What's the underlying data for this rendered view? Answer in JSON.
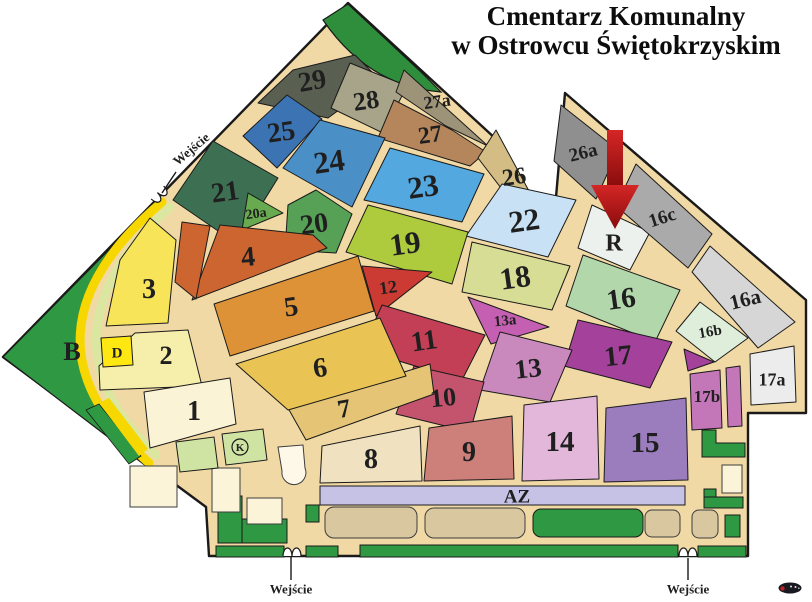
{
  "title": {
    "line1": "Cmentarz Komunalny",
    "line2": "w Ostrowcu Świętokrzyskim"
  },
  "map": {
    "width": 812,
    "height": 602,
    "colors": {
      "path": "#f1d9a5",
      "outline": "#1a1a1a",
      "label": "#1f1f1f"
    },
    "outline_points": "348,3 497,140 553,232 565,93 806,300 806,413 748,413 748,556 209,556 206,507 3,357",
    "park_shapes": [
      {
        "name": "grove-top-corner",
        "type": "path",
        "d": "M 323,20 L 348,4 L 420,71 L 441,92 Q 368,86 323,20 Z",
        "fill": "#2e8e3c",
        "stroke": "#1a1a1a",
        "sw": 1.2
      },
      {
        "name": "park-b-area",
        "type": "path",
        "d": "M 160,198 L 3,357 L 146,466 Q 0,335 160,198 Z",
        "fill": "#2f9842",
        "stroke": "#1a1a1a",
        "sw": 1.2
      },
      {
        "name": "band-yellow",
        "type": "path",
        "d": "M 162,202 Q 5,336 149,463",
        "fill": "none",
        "stroke": "#f6d800",
        "sw": 9
      },
      {
        "name": "band-pale-green",
        "type": "path",
        "d": "M 170,207 Q 30,336 156,455",
        "fill": "none",
        "stroke": "#dbe7a0",
        "sw": 9
      },
      {
        "name": "edge-strip-green",
        "type": "polygon",
        "points": "86,410 99,404 141,456 129,464",
        "fill": "#2f9842",
        "stroke": "#1a1a1a",
        "sw": 0.8
      },
      {
        "name": "edge-strip-yellow",
        "type": "polygon",
        "points": "99,403 109,398 148,449 139,456",
        "fill": "#f6d800",
        "stroke": "none",
        "sw": 0
      }
    ],
    "sections": [
      {
        "id": "29",
        "label": "29",
        "color": "#5a6051",
        "points": "293,70 355,55 380,80 328,118 258,103",
        "lx": 312,
        "ly": 80,
        "fs": 28,
        "rot": -10
      },
      {
        "id": "28",
        "label": "28",
        "color": "#a8a489",
        "points": "350,63 407,86 383,133 331,108",
        "lx": 366,
        "ly": 100,
        "fs": 26,
        "rot": -8
      },
      {
        "id": "27a",
        "label": "27a",
        "color": "#9d9378",
        "points": "404,70 488,146 446,126 396,92",
        "lx": 437,
        "ly": 101,
        "fs": 18,
        "rot": -8
      },
      {
        "id": "27",
        "label": "27",
        "color": "#b5855c",
        "points": "394,100 452,130 486,152 470,166 378,138",
        "lx": 430,
        "ly": 134,
        "fs": 24,
        "rot": -8
      },
      {
        "id": "26",
        "label": "26",
        "color": "#d3bd85",
        "points": "496,130 549,228 524,218 478,158",
        "lx": 514,
        "ly": 176,
        "fs": 24,
        "rot": -8
      },
      {
        "id": "26a",
        "label": "26a",
        "color": "#8f8f8f",
        "points": "561,105 618,150 596,199 554,161",
        "lx": 583,
        "ly": 152,
        "fs": 19,
        "rot": -14
      },
      {
        "id": "25",
        "label": "25",
        "color": "#3c73b3",
        "points": "287,95 322,119 277,168 243,136",
        "lx": 281,
        "ly": 131,
        "fs": 28,
        "rot": -8
      },
      {
        "id": "24",
        "label": "24",
        "color": "#4b8fc7",
        "points": "320,120 385,138 352,207 283,168",
        "lx": 329,
        "ly": 161,
        "fs": 31,
        "rot": -8
      },
      {
        "id": "23",
        "label": "23",
        "color": "#54a8e0",
        "points": "390,148 484,174 462,222 364,200",
        "lx": 423,
        "ly": 186,
        "fs": 31,
        "rot": -8
      },
      {
        "id": "22",
        "label": "22",
        "color": "#c9e1f5",
        "points": "502,184 576,200 548,257 466,236",
        "lx": 524,
        "ly": 220,
        "fs": 31,
        "rot": -8
      },
      {
        "id": "21",
        "label": "21",
        "color": "#3d6f53",
        "points": "213,141 278,178 237,244 173,200",
        "lx": 225,
        "ly": 191,
        "fs": 28,
        "rot": -8
      },
      {
        "id": "20a",
        "label": "20a",
        "color": "#68aa50",
        "points": "248,193 283,213 242,230",
        "lx": 256,
        "ly": 213,
        "fs": 14,
        "rot": -8
      },
      {
        "id": "20",
        "label": "20",
        "color": "#56a156",
        "points": "288,205 316,190 352,214 336,253 285,250",
        "lx": 314,
        "ly": 223,
        "fs": 28,
        "rot": -8
      },
      {
        "id": "19",
        "label": "19",
        "color": "#aeca3d",
        "points": "368,205 468,232 452,284 346,252",
        "lx": 405,
        "ly": 243,
        "fs": 31,
        "rot": -8
      },
      {
        "id": "18",
        "label": "18",
        "color": "#d7dd95",
        "points": "472,242 570,266 552,310 462,292",
        "lx": 515,
        "ly": 277,
        "fs": 31,
        "rot": -8
      },
      {
        "id": "R",
        "label": "R",
        "color": "#edf1ed",
        "points": "592,205 650,232 630,270 578,248",
        "lx": 614,
        "ly": 242,
        "fs": 24,
        "rot": 0
      },
      {
        "id": "16c",
        "label": "16c",
        "color": "#aaaaaa",
        "points": "636,164 712,234 688,268 616,206",
        "lx": 662,
        "ly": 217,
        "fs": 19,
        "rot": -18
      },
      {
        "id": "16",
        "label": "16",
        "color": "#b2d7ab",
        "points": "583,255 680,290 655,342 566,306",
        "lx": 621,
        "ly": 298,
        "fs": 29,
        "rot": -8
      },
      {
        "id": "16a",
        "label": "16a",
        "color": "#d6d6d6",
        "points": "710,246 795,322 758,348 692,272",
        "lx": 745,
        "ly": 299,
        "fs": 21,
        "rot": -14
      },
      {
        "id": "16b",
        "label": "16b",
        "color": "#dfeeda",
        "points": "700,302 748,338 715,362 676,331",
        "lx": 710,
        "ly": 331,
        "fs": 15,
        "rot": -10
      },
      {
        "id": "17",
        "label": "17",
        "color": "#a3419b",
        "points": "578,320 672,342 650,388 564,366",
        "lx": 618,
        "ly": 355,
        "fs": 28,
        "rot": -6
      },
      {
        "id": "17t",
        "label": "",
        "color": "#a3419b",
        "points": "684,349 714,362 688,371",
        "lx": 0,
        "ly": 0,
        "fs": 0,
        "rot": 0
      },
      {
        "id": "17a",
        "label": "17a",
        "color": "#ececec",
        "points": "750,354 794,346 796,402 751,405",
        "lx": 772,
        "ly": 379,
        "fs": 18,
        "rot": 0
      },
      {
        "id": "17b",
        "label": "17b",
        "color": "#c377b8",
        "points": "690,374 720,370 722,428 692,430",
        "lx": 707,
        "ly": 396,
        "fs": 17,
        "rot": 0
      },
      {
        "id": "17b2",
        "label": "",
        "color": "#c377b8",
        "points": "726,368 740,366 742,426 728,427",
        "lx": 0,
        "ly": 0,
        "fs": 0,
        "rot": 0
      },
      {
        "id": "13a",
        "label": "13a",
        "color": "#c45fb2",
        "points": "468,297 549,327 491,344",
        "lx": 505,
        "ly": 320,
        "fs": 15,
        "rot": -6
      },
      {
        "id": "13",
        "label": "13",
        "color": "#c989bd",
        "points": "500,332 572,350 550,402 480,390",
        "lx": 528,
        "ly": 368,
        "fs": 27,
        "rot": -6
      },
      {
        "id": "14",
        "label": "14",
        "color": "#e3b7da",
        "points": "524,405 597,396 599,479 522,481",
        "lx": 560,
        "ly": 441,
        "fs": 29,
        "rot": 0
      },
      {
        "id": "15",
        "label": "15",
        "color": "#9b7cbc",
        "points": "606,408 686,398 688,480 604,482",
        "lx": 645,
        "ly": 442,
        "fs": 29,
        "rot": 0
      },
      {
        "id": "12",
        "label": "12",
        "color": "#cb3a33",
        "points": "362,266 432,272 376,316",
        "lx": 388,
        "ly": 287,
        "fs": 18,
        "rot": -8
      },
      {
        "id": "11",
        "label": "11",
        "color": "#c23f55",
        "points": "382,305 485,335 462,380 362,350",
        "lx": 424,
        "ly": 340,
        "fs": 28,
        "rot": -8
      },
      {
        "id": "10",
        "label": "10",
        "color": "#c4546e",
        "points": "414,366 484,382 470,432 396,414",
        "lx": 443,
        "ly": 397,
        "fs": 26,
        "rot": -6
      },
      {
        "id": "9",
        "label": "9",
        "color": "#cd7f79",
        "points": "429,428 512,416 514,479 424,481",
        "lx": 469,
        "ly": 451,
        "fs": 28,
        "rot": 0
      },
      {
        "id": "8",
        "label": "8",
        "color": "#f0e2c0",
        "points": "322,446 420,426 422,481 320,483",
        "lx": 371,
        "ly": 458,
        "fs": 28,
        "rot": 0
      },
      {
        "id": "7",
        "label": "7",
        "color": "#e5c476",
        "points": "288,408 430,364 434,394 306,440",
        "lx": 344,
        "ly": 408,
        "fs": 26,
        "rot": -10
      },
      {
        "id": "6",
        "label": "6",
        "color": "#e9c454",
        "points": "236,364 380,318 406,376 288,410",
        "lx": 320,
        "ly": 367,
        "fs": 28,
        "rot": -8
      },
      {
        "id": "5",
        "label": "5",
        "color": "#de9238",
        "points": "214,304 358,256 374,311 230,356",
        "lx": 291,
        "ly": 306,
        "fs": 28,
        "rot": -8
      },
      {
        "id": "4",
        "label": "4",
        "color": "#cd6531",
        "points": "220,225 313,235 327,248 192,300",
        "lx": 248,
        "ly": 256,
        "fs": 28,
        "rot": -5
      },
      {
        "id": "4b",
        "label": "",
        "color": "#cd6531",
        "points": "182,222 210,226 196,299 175,282",
        "lx": 0,
        "ly": 0,
        "fs": 0,
        "rot": 0
      },
      {
        "id": "3",
        "label": "3",
        "color": "#f8e459",
        "points": "120,260 150,218 176,240 168,323 106,326",
        "lx": 149,
        "ly": 288,
        "fs": 28,
        "rot": 0
      },
      {
        "id": "2",
        "label": "2",
        "color": "#f6efab",
        "points": "99,366 135,333 188,330 202,386 100,390",
        "lx": 166,
        "ly": 355,
        "fs": 26,
        "rot": 0
      },
      {
        "id": "1",
        "label": "1",
        "color": "#faf3d5",
        "points": "144,392 230,378 236,424 150,448",
        "lx": 194,
        "ly": 410,
        "fs": 28,
        "rot": 0
      },
      {
        "id": "D",
        "label": "D",
        "color": "#ffe712",
        "points": "101,338 131,336 133,365 103,367",
        "lx": 117,
        "ly": 352,
        "fs": 15,
        "rot": 0
      }
    ],
    "decorations": [
      {
        "name": "green-strip",
        "type": "rect",
        "x": 218,
        "y": 496,
        "w": 24,
        "h": 47,
        "rx": 0,
        "fill": "#2f9842",
        "stroke": "#1a1a1a"
      },
      {
        "name": "green-strip",
        "type": "rect",
        "x": 242,
        "y": 519,
        "w": 45,
        "h": 24,
        "rx": 0,
        "fill": "#2f9842",
        "stroke": "#1a1a1a"
      },
      {
        "name": "green-strip",
        "type": "rect",
        "x": 216,
        "y": 546,
        "w": 68,
        "h": 11,
        "rx": 0,
        "fill": "#2f9842",
        "stroke": "#1a1a1a"
      },
      {
        "name": "green-strip",
        "type": "rect",
        "x": 306,
        "y": 546,
        "w": 32,
        "h": 11,
        "rx": 0,
        "fill": "#2f9842",
        "stroke": "#1a1a1a"
      },
      {
        "name": "green-strip",
        "type": "rect",
        "x": 360,
        "y": 545,
        "w": 318,
        "h": 12,
        "rx": 0,
        "fill": "#2f9842",
        "stroke": "#1a1a1a"
      },
      {
        "name": "green-strip",
        "type": "rect",
        "x": 698,
        "y": 546,
        "w": 48,
        "h": 11,
        "rx": 0,
        "fill": "#2f9842",
        "stroke": "#1a1a1a"
      },
      {
        "name": "green-strip",
        "type": "polygon",
        "points": "702,430 716,430 716,443 745,443 745,457 702,457",
        "fill": "#2f9842",
        "stroke": "#1a1a1a"
      },
      {
        "name": "green-strip",
        "type": "rect",
        "x": 704,
        "y": 489,
        "w": 12,
        "h": 19,
        "rx": 0,
        "fill": "#2f9842",
        "stroke": "#1a1a1a"
      },
      {
        "name": "green-strip",
        "type": "rect",
        "x": 704,
        "y": 497,
        "w": 39,
        "h": 11,
        "rx": 0,
        "fill": "#2f9842",
        "stroke": "#1a1a1a"
      },
      {
        "name": "green-strip",
        "type": "rect",
        "x": 725,
        "y": 515,
        "w": 15,
        "h": 22,
        "rx": 0,
        "fill": "#2f9842",
        "stroke": "#1a1a1a"
      },
      {
        "name": "green-lawn",
        "type": "rect",
        "x": 533,
        "y": 509,
        "w": 110,
        "h": 28,
        "rx": 8,
        "fill": "#2f9842",
        "stroke": "#1a1a1a"
      },
      {
        "name": "green-strip",
        "type": "rect",
        "x": 306,
        "y": 505,
        "w": 13,
        "h": 17,
        "rx": 0,
        "fill": "#2f9842",
        "stroke": "#1a1a1a"
      },
      {
        "name": "building",
        "type": "rect",
        "x": 325,
        "y": 507,
        "w": 92,
        "h": 31,
        "rx": 9,
        "fill": "#d8c79f",
        "stroke": "#3d3d3d"
      },
      {
        "name": "building",
        "type": "rect",
        "x": 425,
        "y": 508,
        "w": 100,
        "h": 30,
        "rx": 9,
        "fill": "#d8c79f",
        "stroke": "#3d3d3d"
      },
      {
        "name": "building",
        "type": "rect",
        "x": 645,
        "y": 510,
        "w": 35,
        "h": 27,
        "rx": 7,
        "fill": "#d8c79f",
        "stroke": "#3d3d3d"
      },
      {
        "name": "building",
        "type": "rect",
        "x": 692,
        "y": 510,
        "w": 26,
        "h": 28,
        "rx": 7,
        "fill": "#d8c79f",
        "stroke": "#3d3d3d"
      },
      {
        "name": "building-cream",
        "type": "rect",
        "x": 130,
        "y": 466,
        "w": 47,
        "h": 41,
        "rx": 0,
        "fill": "#fbf4d8",
        "stroke": "#3d3d3d"
      },
      {
        "name": "building-cream",
        "type": "rect",
        "x": 212,
        "y": 468,
        "w": 28,
        "h": 44,
        "rx": 0,
        "fill": "#fbf4d8",
        "stroke": "#3d3d3d"
      },
      {
        "name": "building-cream",
        "type": "rect",
        "x": 247,
        "y": 498,
        "w": 35,
        "h": 26,
        "rx": 0,
        "fill": "#fbf4d8",
        "stroke": "#3d3d3d"
      },
      {
        "name": "building-cream",
        "type": "rect",
        "x": 722,
        "y": 465,
        "w": 20,
        "h": 28,
        "rx": 0,
        "fill": "#fbf4d8",
        "stroke": "#3d3d3d"
      },
      {
        "name": "chapel-building",
        "type": "path",
        "d": "M 278,447 L 303,445 L 305,468 A 12,12 0 1 1 282,471 Z",
        "fill": "#fdf8e8",
        "stroke": "#3d3d3d",
        "sw": 1
      },
      {
        "name": "field-light-green",
        "type": "polygon",
        "points": "176,442 214,437 218,468 180,472",
        "fill": "#cfe3a2",
        "stroke": "#1a1a1a"
      },
      {
        "name": "field-light-green",
        "type": "polygon",
        "points": "222,434 263,429 267,460 226,465",
        "fill": "#cfe3a2",
        "stroke": "#1a1a1a"
      }
    ],
    "az": {
      "label": "AZ",
      "x": 320,
      "y": 486,
      "w": 365,
      "h": 19,
      "fill": "#c6c2e6",
      "label_x": 517,
      "label_y": 496,
      "fs": 19
    },
    "b_label": {
      "text": "B",
      "x": 72,
      "y": 351,
      "fs": 26
    },
    "k_badge": {
      "text": "K",
      "cx": 240,
      "cy": 447,
      "r": 8,
      "fs": 11
    },
    "arrow": {
      "color_top": "#d62626",
      "color_bottom": "#870c0c",
      "shaft": "607,130 623,130 623,188 607,188",
      "head": "591,185 639,185 615,229"
    },
    "gates": [
      {
        "x": 161,
        "y": 196,
        "rot": 134
      },
      {
        "x": 292,
        "y": 551,
        "rot": 0
      },
      {
        "x": 688,
        "y": 551,
        "rot": 0
      }
    ],
    "entrances": [
      {
        "label": "Wejście",
        "x": 191,
        "y": 149,
        "rot": -40,
        "fs": 13,
        "line": {
          "x1": 176,
          "y1": 172,
          "x2": 162,
          "y2": 193
        }
      },
      {
        "label": "Wejście",
        "x": 291,
        "y": 589,
        "rot": 0,
        "fs": 13,
        "line": {
          "x1": 291,
          "y1": 556,
          "x2": 291,
          "y2": 580
        }
      },
      {
        "label": "Wejście",
        "x": 688,
        "y": 589,
        "rot": 0,
        "fs": 13,
        "line": {
          "x1": 688,
          "y1": 558,
          "x2": 688,
          "y2": 580
        }
      }
    ],
    "car_icon": {
      "cx": 790,
      "cy": 588
    }
  }
}
